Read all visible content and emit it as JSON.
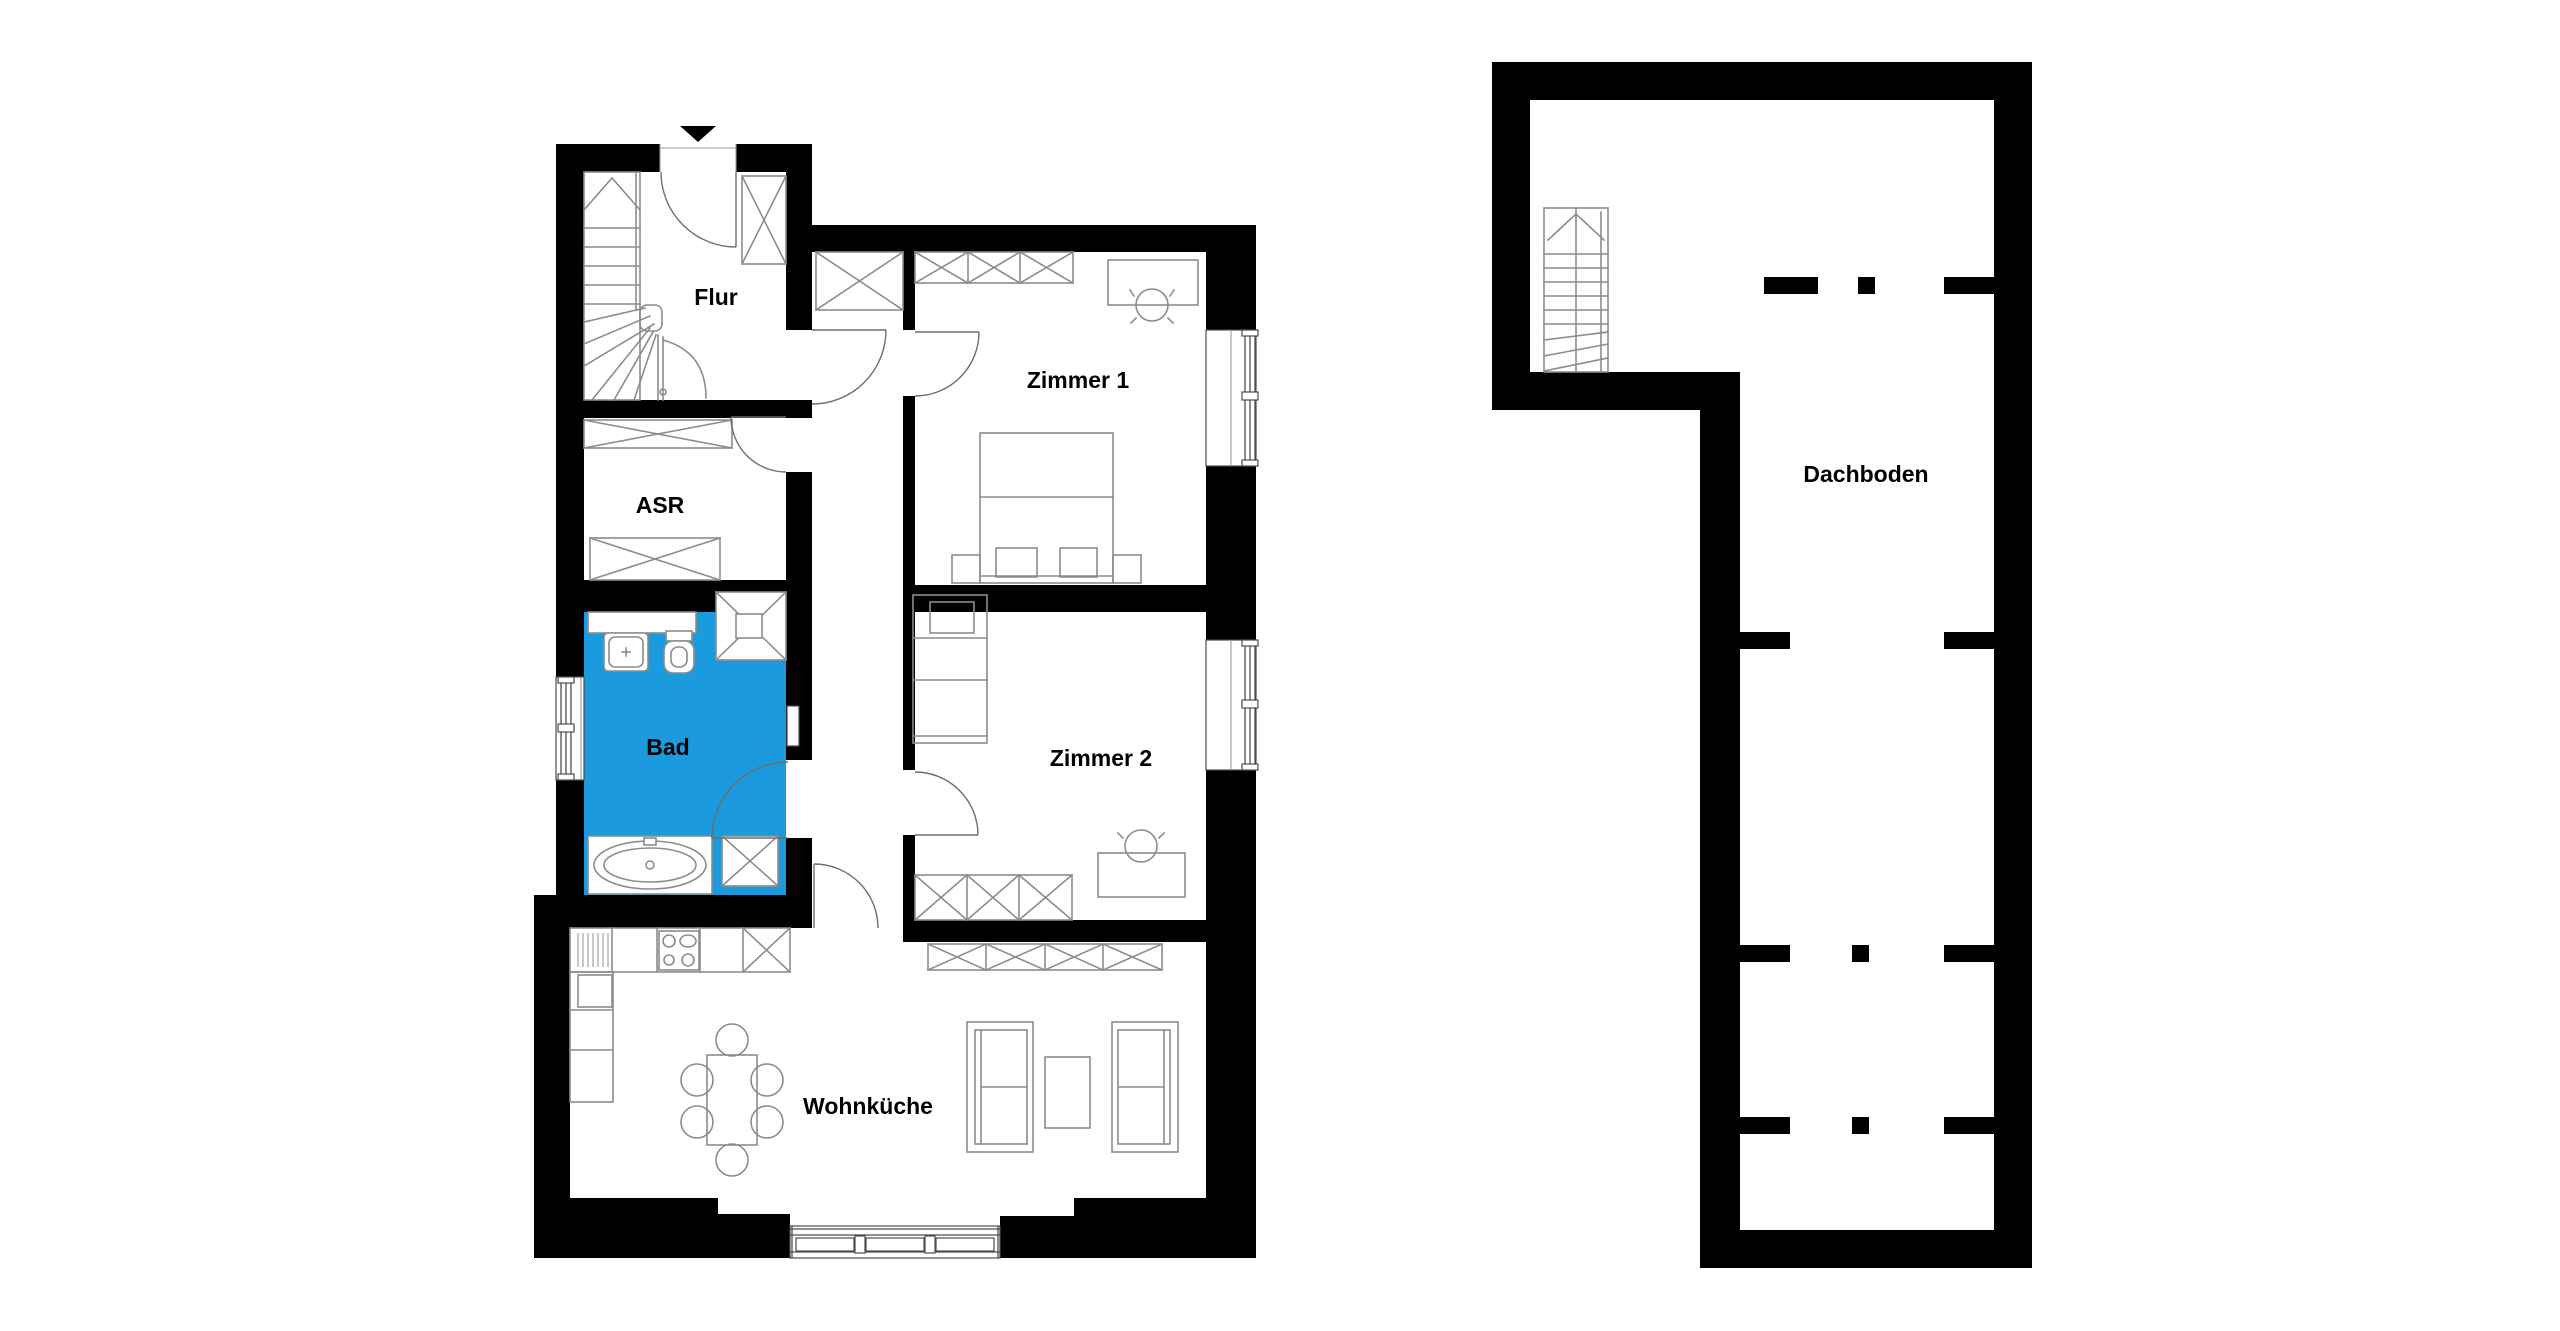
{
  "rooms": {
    "flur": "Flur",
    "asr": "ASR",
    "bad": "Bad",
    "zimmer1": "Zimmer 1",
    "zimmer2": "Zimmer 2",
    "wohnkueche": "Wohnküche",
    "dachboden": "Dachboden"
  },
  "colors": {
    "wall": "#000000",
    "furniture_line": "#8c8c8c",
    "door_line": "#6e6e6e",
    "bad_room_fill": "#1b9ade",
    "background": "#ffffff",
    "label_text": "#000000"
  },
  "icons": {
    "entry_arrow": "▼"
  }
}
